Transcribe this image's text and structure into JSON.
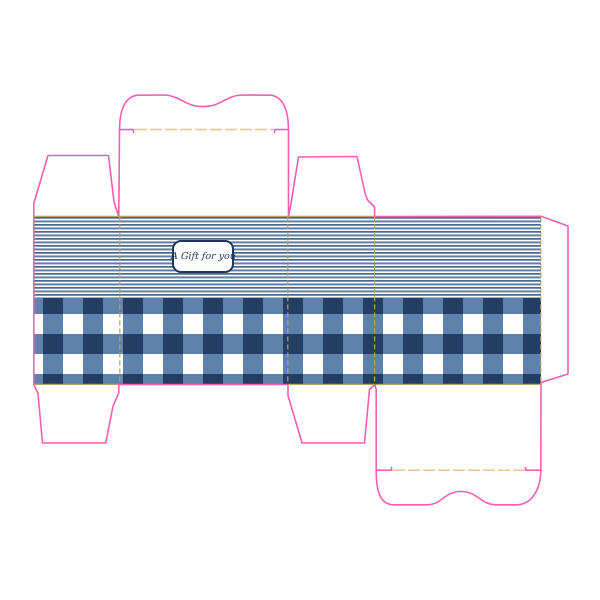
{
  "page": {
    "title": "Gift box die-cut template"
  },
  "label": {
    "text": "A Gift for you"
  },
  "patterns": {
    "top_band": "horizontal blue pinstripes",
    "bottom_band": "blue gingham check"
  },
  "colors": {
    "background": "#ffffff",
    "cut_line": "#f25fb3",
    "fold_line": "#eac897",
    "fold_line_on_pattern": "#b3a468",
    "stripe_dark": "#49688e",
    "stripe_mid": "#7b93b1",
    "stripe_white": "#ffffff",
    "gingham_dark": "#233d63",
    "gingham_mid": "#5e82ac",
    "gingham_white": "#ffffff",
    "label_border": "#20365c",
    "label_text": "#20365c",
    "label_background": "#ffffff"
  }
}
